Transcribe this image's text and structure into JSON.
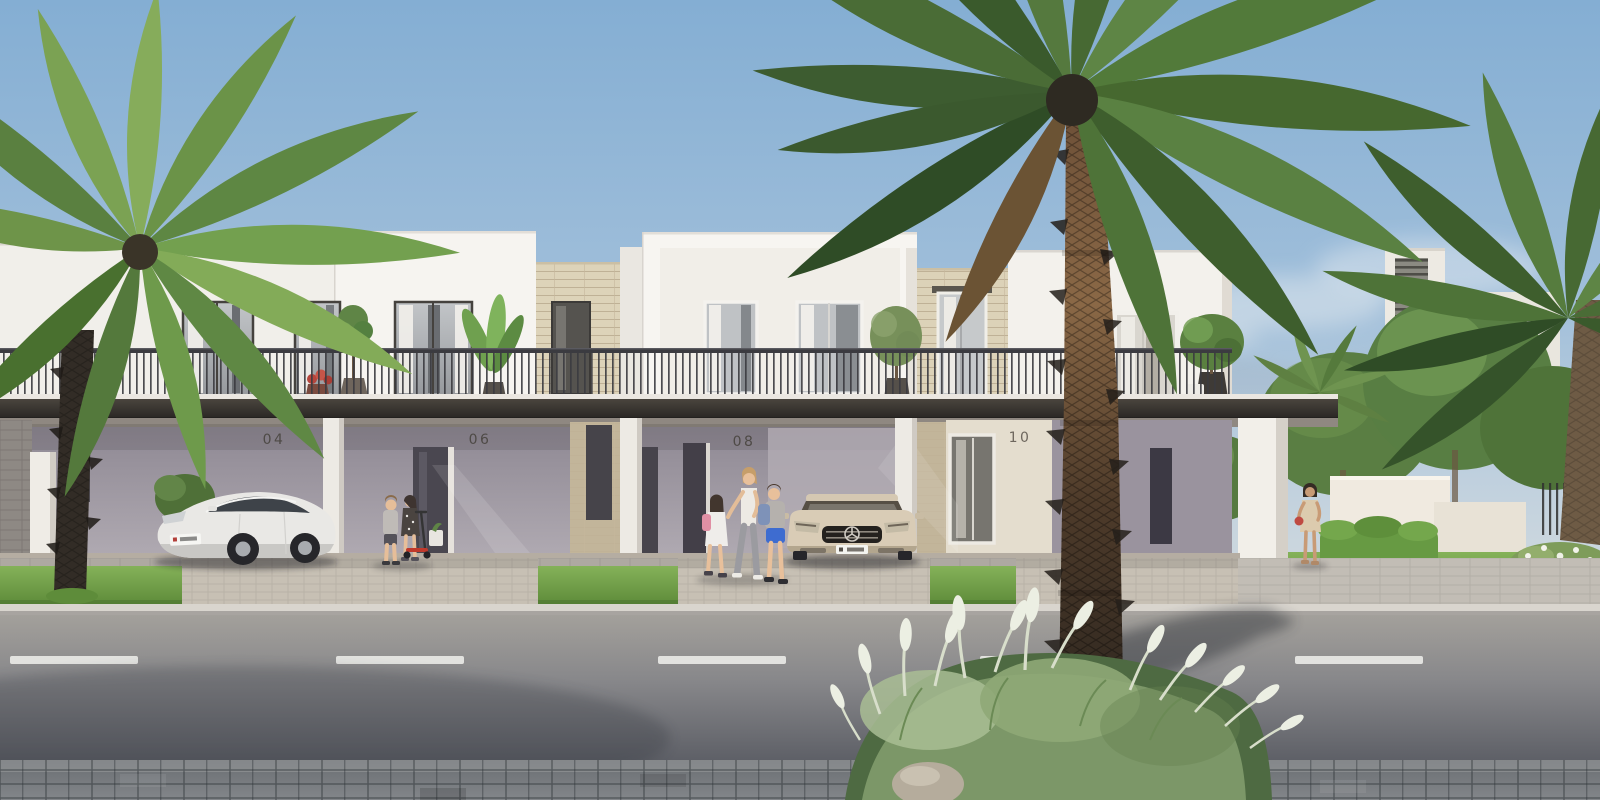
{
  "scene": {
    "type": "photorealistic architectural rendering",
    "subject": "row of modern two-storey townhouses with covered carports on a palm-lined street",
    "lighting": "bright daylight, clear blue sky with light haze",
    "camera": "street-level elevation view from across the road"
  },
  "houses": [
    {
      "number": "04",
      "detail": "white sedan parked in carport, balcony with potted tree and red-flower planter"
    },
    {
      "number": "06",
      "detail": "two children playing with a red kick scooter by the entry door"
    },
    {
      "number": "08",
      "detail": "mother walking two school children, champagne coupe parked in carport"
    },
    {
      "number": "10",
      "detail": "sunlit glass entry, balcony tree and chair, empty carport"
    }
  ],
  "architecture": {
    "walls": "white render with beige stone feature panels",
    "canopy": "continuous dark carport canopy across the ground floor",
    "balcony": "full-width dark vertical-bar metal railing",
    "windows": "full-height glazing with sheer white curtains"
  },
  "vehicles": [
    {
      "name": "white-sedan",
      "body_color": "#E9E8E5",
      "location": "carport of house 04",
      "plate": "white plate, illegible"
    },
    {
      "name": "champagne-coupe",
      "body_color": "#D9CCB6",
      "location": "carport of house 08",
      "plate": "white plate, illegible",
      "front_badge": "three-pointed star"
    }
  ],
  "people": [
    {
      "name": "girl-with-pink-backpack",
      "desc": "white dress, pink backpack, dark hair"
    },
    {
      "name": "mother",
      "desc": "white sleeveless top, grey trousers, blonde hair"
    },
    {
      "name": "boy-with-blue-backpack",
      "desc": "grey t-shirt, blue shorts, blue backpack"
    },
    {
      "name": "boy-at-house-06",
      "desc": "grey long-sleeve top, dark shorts"
    },
    {
      "name": "girl-at-house-06",
      "desc": "dark floral dress, standing with red scooter"
    },
    {
      "name": "woman-in-beige-dress",
      "desc": "beige dress, red handbag, walking near end column"
    }
  ],
  "vegetation": {
    "foreground_palm": "large date palm with dark trimmed trunk, centre-right",
    "left_palm": "date palm with dark trunk at left kerb",
    "right_palm": "background palm at far right edge",
    "ornamental_grasses": "white-plumed fountain grasses and boulder at palm base, bottom right",
    "hedges_trees": "clipped hedge, lawn and mature trees behind right boundary walls",
    "balcony_plants": "potted olive, ficus and banana plants on balconies"
  },
  "street": {
    "road": "grey asphalt",
    "lane_marking": "white dashed centre line",
    "sidewalk": "light paver sidewalk with grass verge strips",
    "foreground": "dark grey paver walkway"
  },
  "palette": {
    "sky_top": "#84AED3",
    "sky_horizon": "#D9DEDE",
    "wall_white": "#F4F2EE",
    "stone_beige": "#DCD2B8",
    "canopy_dark": "#332F2A",
    "recess_wall": "#A39DA8",
    "grass_green": "#74A248",
    "hedge_green": "#679A43",
    "asphalt": "#87878A",
    "lane_marking": "#E9E9E6",
    "paver_dark": "#5E6165",
    "palm_green": "#4A6C36",
    "sedan_white": "#E9E8E5",
    "coupe_champagne": "#D9CCB6",
    "scooter_red": "#C0392B",
    "backpack_pink": "#E08FA4",
    "backpack_blue": "#7E92B8",
    "handbag_red": "#BF4A42"
  }
}
